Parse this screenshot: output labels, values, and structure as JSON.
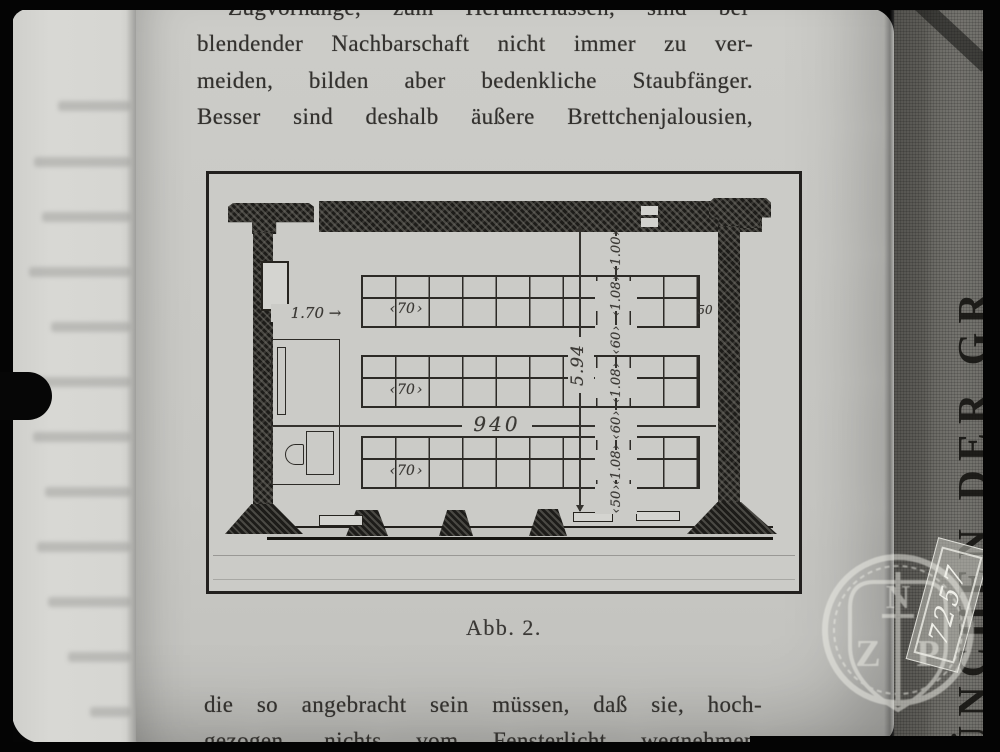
{
  "document": {
    "paragraph_top": [
      "Zugvorhänge, zum Herunterlassen, sind bei",
      "blendender Nachbarschaft nicht immer zu ver-",
      "meiden, bilden aber bedenkliche Staubfänger.",
      "Besser sind deshalb äußere Brettchenjalousien,"
    ],
    "paragraph_bottom": [
      "die so angebracht sein müssen, daß sie, hoch-",
      "gezogen, nichts vom Fensterlicht wegnehmen."
    ],
    "figure": {
      "caption": "Abb. 2.",
      "dims": {
        "front_gap": "1.70",
        "desk_width": "70",
        "room_width": "940",
        "room_depth": "5.94",
        "side_gap": "50",
        "chain": [
          "1.00",
          "1.08",
          "60",
          "1.08",
          "60",
          "1.08",
          "50"
        ]
      }
    }
  },
  "binding": {
    "spine_text": "ÜNCHEN DER GR",
    "stamp": {
      "top": "N",
      "left": "Z",
      "right": "P"
    },
    "slip_number": "7257"
  },
  "colors": {
    "paper": "#c9c9c5",
    "ink": "#33312e",
    "cover_cloth": "#6c6b66",
    "border": "#040404"
  }
}
